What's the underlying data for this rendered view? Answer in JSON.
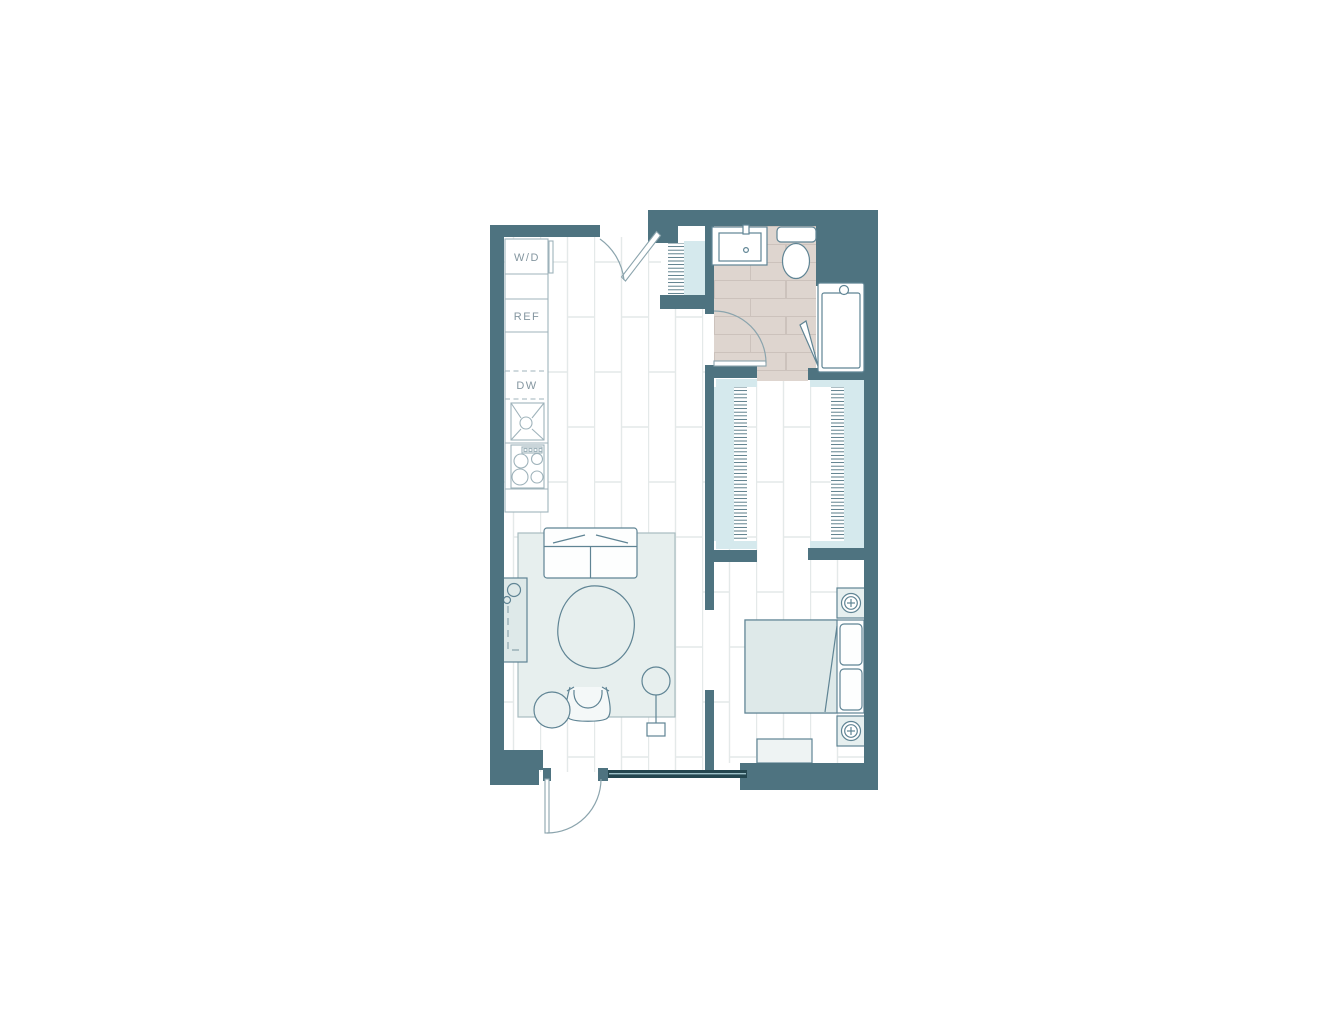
{
  "title": "apartment-floor-plan",
  "colors": {
    "wall": "#4e7380",
    "window-frame": "#24464f",
    "window-glass": "#9cc0c8",
    "plank-line": "#e4e9e9",
    "tile": "#ded5cf",
    "tile-line": "#ccc2bc",
    "rug": "#e7efee",
    "rug-edge": "#a8bcc0",
    "soft": "#dee9e9",
    "rod": "#d5e9ed",
    "outline": "#5f8494",
    "outline-light": "#9fb3bb",
    "arc": "#8ba4ad",
    "label": "#8496a0"
  },
  "plan": {
    "kitchen": {
      "appliances": [
        {
          "name": "washer-dryer",
          "label": "W/D"
        },
        {
          "name": "refrigerator",
          "label": "REF"
        },
        {
          "name": "dishwasher",
          "label": "DW"
        },
        {
          "name": "kitchen-sink",
          "label": ""
        },
        {
          "name": "cooktop",
          "label": ""
        }
      ]
    },
    "bathroom": {
      "fixtures": [
        "vanity-sink",
        "toilet",
        "shower"
      ],
      "door": "swing-door"
    },
    "entry": {
      "door": "swing-door",
      "closet": "hanging-rod-closet"
    },
    "walk_in_closet": {
      "hanging_rods": 2
    },
    "living_room": {
      "furniture": [
        "sofa",
        "coffee-table",
        "armchair",
        "side-table",
        "floor-lamp",
        "media-console",
        "rug"
      ]
    },
    "bedroom": {
      "furniture": [
        "bed",
        "pillows",
        "nightstand",
        "nightstand",
        "table-lamp",
        "table-lamp",
        "dresser"
      ]
    },
    "window": {
      "type": "window-band"
    }
  }
}
